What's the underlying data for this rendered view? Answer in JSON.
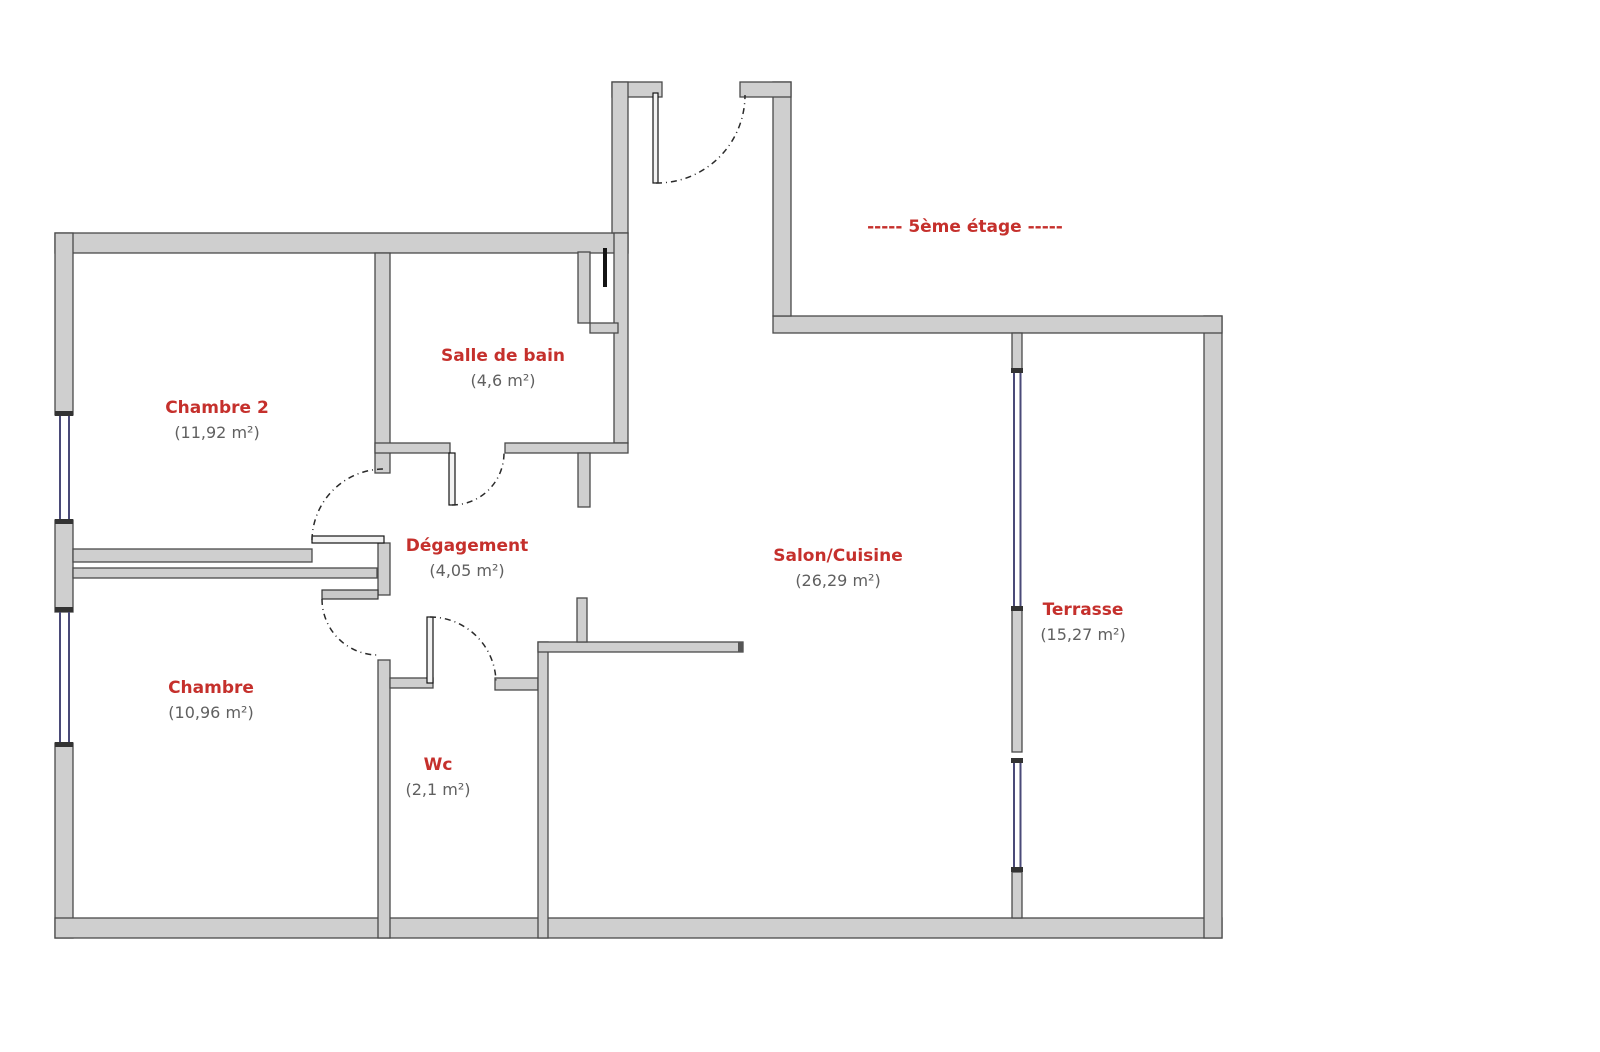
{
  "title": "----- 5ème étage -----",
  "rooms": [
    {
      "name": "Chambre 2",
      "area": "(11,92 m²)"
    },
    {
      "name": "Salle de bain",
      "area": "(4,6 m²)"
    },
    {
      "name": "Dégagement",
      "area": "(4,05 m²)"
    },
    {
      "name": "Chambre",
      "area": "(10,96 m²)"
    },
    {
      "name": "Wc",
      "area": "(2,1 m²)"
    },
    {
      "name": "Salon/Cuisine",
      "area": "(26,29 m²)"
    },
    {
      "name": "Terrasse",
      "area": "(15,27 m²)"
    }
  ],
  "colors": {
    "room_label": "#c5302c",
    "area_label": "#606060",
    "title": "#c5302c",
    "wall_fill": "#cfcfcf",
    "wall_edge": "#4a4a4a",
    "window": "#4a4a78",
    "background": "#ffffff"
  }
}
